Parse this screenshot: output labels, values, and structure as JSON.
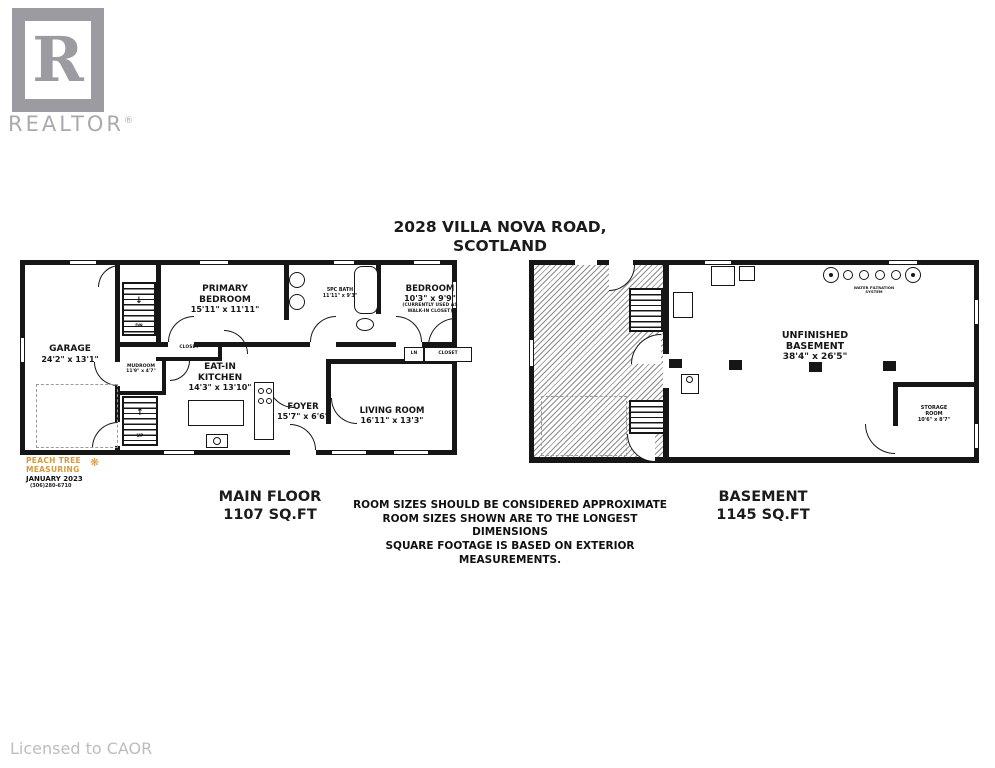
{
  "branding": {
    "realtor_logo_letter": "R",
    "realtor_wordmark": "REALTOR",
    "registered_symbol": "®",
    "licensed_to": "Licensed to CAOR"
  },
  "title": {
    "line1": "2028 VILLA NOVA ROAD,",
    "line2": "SCOTLAND"
  },
  "measuring_credit": {
    "company_line1": "PEACH TREE",
    "company_line2": "MEASURING",
    "tree_icon": "❋",
    "date": "JANUARY 2023",
    "phone": "(306)280-6710"
  },
  "main_floor": {
    "footer_label": "MAIN FLOOR",
    "footer_sqft": "1107 SQ.FT",
    "rooms": {
      "garage": {
        "name": "GARAGE",
        "dims": "24'2\" x 13'1\""
      },
      "primary_bedroom": {
        "name_line1": "PRIMARY",
        "name_line2": "BEDROOM",
        "dims": "15'11\" x 11'11\""
      },
      "bath": {
        "name": "5PC BATH",
        "dims": "11'11\" x 9'3\""
      },
      "bedroom": {
        "name": "BEDROOM",
        "dims": "10'3\" x 9'9\"",
        "note_line1": "(CURRENTLY USED AS",
        "note_line2": "WALK-IN CLOSET)"
      },
      "mudroom": {
        "name": "MUDROOM",
        "dims": "11'9\" x 4'7\""
      },
      "kitchen": {
        "name_line1": "EAT-IN",
        "name_line2": "KITCHEN",
        "dims": "14'3\" x 13'10\""
      },
      "foyer": {
        "name": "FOYER",
        "dims": "15'7\" x 6'6\""
      },
      "living_room": {
        "name": "LIVING ROOM",
        "dims": "16'11\" x 13'3\""
      }
    },
    "annotations": {
      "closet": "CLOSET",
      "linen": "LN",
      "closet2": "CLOSET",
      "down": "DN",
      "up": "UP",
      "down_arrow": "↓",
      "up_arrow": "↑"
    }
  },
  "basement": {
    "footer_label": "BASEMENT",
    "footer_sqft": "1145 SQ.FT",
    "rooms": {
      "unfinished": {
        "name_line1": "UNFINISHED",
        "name_line2": "BASEMENT",
        "dims": "38'4\" x 26'5\""
      },
      "storage": {
        "name_line1": "STORAGE",
        "name_line2": "ROOM",
        "dims": "10'6\" x 8'7\""
      }
    },
    "annotations": {
      "equipment_line1": "WATER FILTRATION",
      "equipment_line2": "SYSTEM"
    }
  },
  "disclaimer": {
    "lines": [
      "ROOM SIZES SHOULD BE CONSIDERED APPROXIMATE",
      "ROOM SIZES SHOWN ARE TO THE LONGEST",
      "DIMENSIONS",
      "SQUARE FOOTAGE IS BASED ON EXTERIOR",
      "MEASUREMENTS."
    ]
  },
  "colors": {
    "wall": "#161616",
    "logo_gray": "#9b9ba1",
    "muted_gray": "#bdbdbd",
    "accent_orange": "#d8993b"
  }
}
